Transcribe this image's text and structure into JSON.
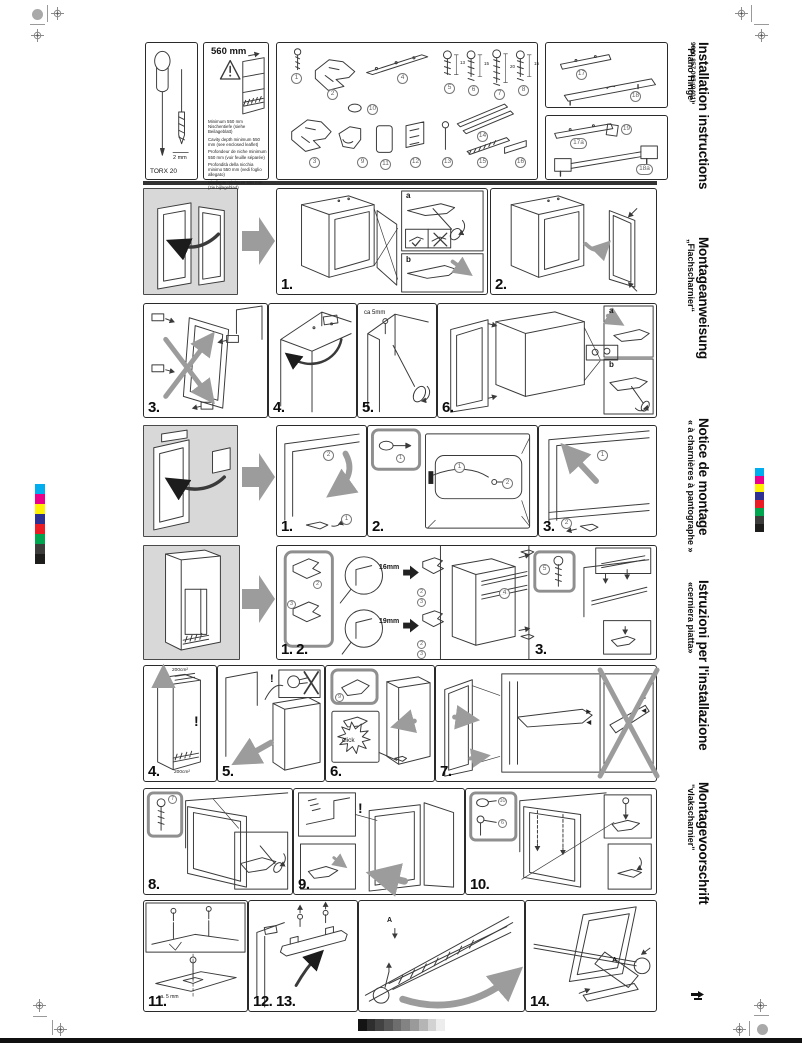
{
  "page": {
    "code": "9000 857 005 (9401)"
  },
  "titles": [
    {
      "title": "Installation instructions",
      "subtitle": "\"Piano Hinge\""
    },
    {
      "title": "Montageanweisung",
      "subtitle": "„Flachscharnier“"
    },
    {
      "title": "Notice de montage",
      "subtitle": "« à charnières à pantographe »"
    },
    {
      "title": "Istruzioni per l'installazione",
      "subtitle": "«cerniera piatta»"
    },
    {
      "title": "Montagevoorschrift",
      "subtitle": "\"vlakscharnier\""
    }
  ],
  "tool": {
    "torx": "TORX 20",
    "size": "2 mm"
  },
  "cavity": {
    "dim": "560 mm",
    "notes": [
      "Minimum 550 mm Nischentiefe (siehe Beilageblatt)",
      "Cavity depth minimum 550 mm (see enclosed leaflet)",
      "Profondeur de niche minimum 550 mm (voir feuille séparée)",
      "Profondità della nicchia minimo 550 mm (vedi foglio allegato)",
      "Nisdiepte minimum 550 mm (zie bijlageblad)"
    ]
  },
  "parts": {
    "nums": [
      "1",
      "2",
      "3",
      "4",
      "5",
      "6",
      "7",
      "8",
      "9",
      "10",
      "11",
      "12",
      "13",
      "14",
      "15",
      "16"
    ],
    "lens": {
      "l5": "13",
      "l6": "15",
      "l7": "20",
      "l8": "15"
    },
    "extra": {
      "p17": "17",
      "p18": "18",
      "p17a": "17a",
      "p19": "19",
      "p18a": "18a"
    }
  },
  "steps": {
    "r1s1": "1.",
    "r1s2": "2.",
    "r2s3": "3.",
    "r2s4": "4.",
    "r2s5": "5.",
    "r2s6": "6.",
    "r3s1": "1.",
    "r3s2": "2.",
    "r3s3": "3.",
    "r4s12": "1. 2.",
    "r4s3": "3.",
    "r5s4": "4.",
    "r5s5": "5.",
    "r5s6": "6.",
    "r5s7": "7.",
    "r6s8": "8.",
    "r6s9": "9.",
    "r6s10": "10.",
    "r7s11": "11.",
    "r7s1213": "12. 13.",
    "r7s14": "14."
  },
  "ann": {
    "a": "a",
    "b": "b",
    "ca5": "ca 5mm",
    "ca5b": "ca. 5 mm",
    "mm16": "16mm",
    "mm19": "19mm",
    "area": "200cm²",
    "excl": "!",
    "click": "click",
    "A": "A"
  },
  "colors": {
    "bar": [
      "#00ADEE",
      "#EB008B",
      "#FFF100",
      "#2E3092",
      "#EC1C24",
      "#00A550",
      "#3C3C3B",
      "#1D1D1B"
    ],
    "grays": [
      "#141414",
      "#2e2e2e",
      "#424242",
      "#575757",
      "#6d6d6d",
      "#838383",
      "#9a9a9a",
      "#b5b5b5",
      "#d2d2d2",
      "#ededed"
    ]
  }
}
